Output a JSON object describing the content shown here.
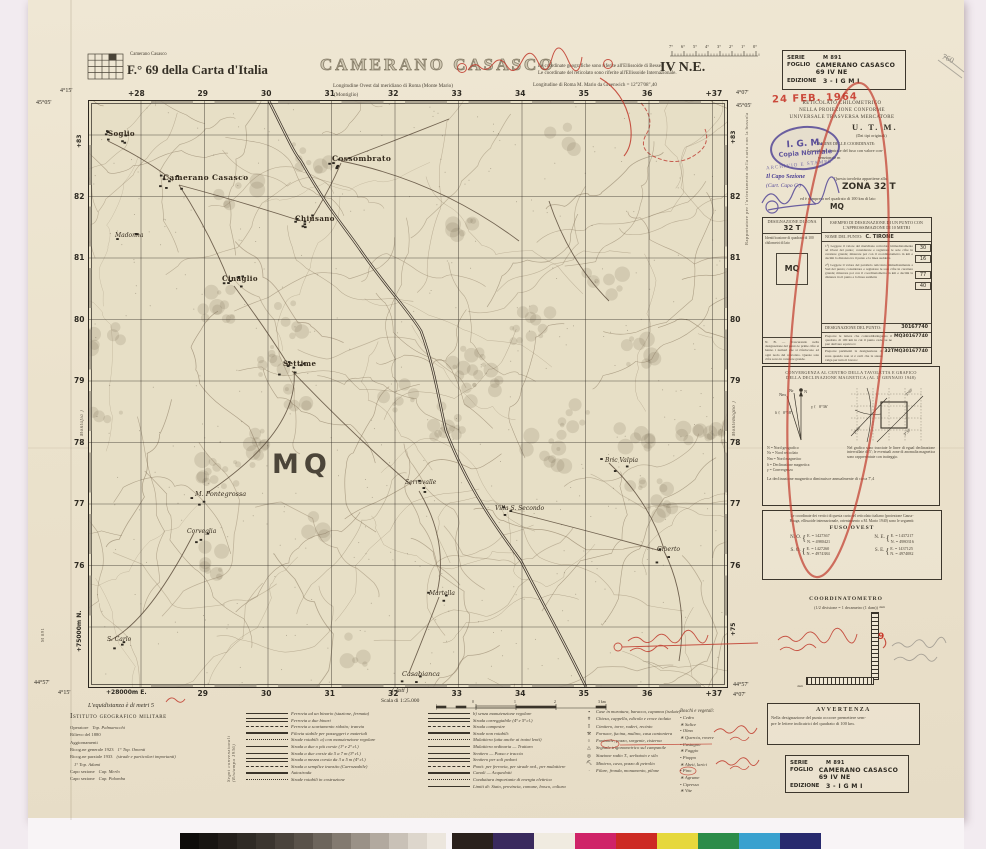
{
  "header": {
    "index_label": "Camerano Casasco",
    "sheet_ref": "F.° 69  della Carta d'Italia",
    "title": "CAMERANO CASASCO",
    "long_west": "Longitudine Ovest dal meridiano di Roma (Monte Mario)",
    "montiglio": "(Montiglio)",
    "coords_note1": "Le coordinate geografiche sono riferite all'Ellissoide di Bessel.",
    "coords_note2": "Le coordinate del reticolato sono riferite all'Ellissoide Internazionale.",
    "long_rome": "Longitudine di Roma M. Mario da Greenwich = 12°27'08\",40",
    "quadrant": "IV N.E.",
    "degree_ticks": [
      "7°",
      "6°",
      "5°",
      "4°",
      "3°",
      "2°",
      "1°",
      "0°"
    ],
    "pencil_note": "760"
  },
  "series_box": {
    "serie_label": "SERIE",
    "serie": "M 891",
    "foglio_label": "FOGLIO",
    "foglio": "CAMERANO CASASCO 69 IV NE",
    "edizione_label": "EDIZIONE",
    "edizione": "3    -  I G M I"
  },
  "stamps": {
    "date": "24 FEB. 1964",
    "igm1": "I. G. M.",
    "igm2": "Copia Normale",
    "igm3": "ARCHIVIO E STAMPE",
    "capo1": "Il Capo Sezione",
    "capo2": "(Cart. Capo C.)"
  },
  "utm": {
    "l1": "RETICOLATO CHILOMETRICO",
    "l2": "NELLA PROIEZIONE CONFORME",
    "l3": "UNIVERSALE TRASVERSA MERCATORE",
    "l4": "U. T. M.",
    "l5": "(Dai tipi originali)",
    "l6": "ORIGINE DELLE COORDINATE:",
    "l7": "il meridiano centrale del fuso con valore con-",
    "l8": "venzionale m",
    "l9": "Questa tavoletta appartiene alla",
    "zona": "ZONA  32 T",
    "l10": "ed è compresa nel quadrato di 100 km di lato",
    "mq": "MQ"
  },
  "desig_table": {
    "c1h": "DESIGNAZIONE DI ZONA",
    "c1zone": "32 T",
    "c1sq": "Identificazione di quadrato di 100 chilometri di lato",
    "c1mq": "MQ",
    "c2h": "ESEMPIO DI DESIGNAZIONE DI UN PUNTO CON L'APPROSSIMAZIONE DI 10 METRI",
    "point_label": "NOME DEL PUNTO:",
    "point": "C. TIRONE",
    "step1": "1°) Leggere il valore del meridiano reticolato immediatamente ad Ovest del punto; considerare e registrare le sole cifre in carattere grande; misurare poi con il coordinatometro in km e decimi la distanza tra il punto e la linea suddetta",
    "n1": "30",
    "n2": "16",
    "step2": "2°) Leggere il valore del parallelo reticolato immediatamente a Sud del punto; considerare e registrare le sole cifre in carattere grande; misurare poi con il coordinatometro in km e decimi la distanza tra il punto e la linea suddetta",
    "n3": "77",
    "n4": "40",
    "desig_label": "DESIGNAZIONE DEL PUNTO:",
    "desig": "30167740",
    "nb": "N. B. — Trascurando nella designazione del punto le prime cifre si hanno i numeri che si riferiscono ad ogni nodo del reticolato. Queste sole cifre sono in carattere grande.",
    "r1": "Preporre le lettere che contraddistinguono il quadrato di 100 km in cui il punto cade, se ne può derivare equivoco:",
    "v1": "MQ30167740",
    "r2": "Preporre parimenti la designazione di zona quando non si è certi che la stessa valga per tutto il lavoro:",
    "v2": "32TMQ30167740"
  },
  "conv_box": {
    "title1": "CONVERGENZA AL CENTRO DELLA TAVOLETTA E GRAFICO",
    "title2": "DELLA DECLINAZIONE MAGNETICA (AL 1° GENNAIO 1948)",
    "val1": "0°36'",
    "val2": "0°58'",
    "diag1": "3°00'",
    "diag2": "2°30'",
    "diag3": "3°30'",
    "legend": [
      "N  =  Nord geografico",
      "Nr =  Nord reticolato",
      "Nm =  Nord magnetico",
      "δ  =  Declinazione magnetica",
      "γ  =  Convergenza"
    ],
    "note": "Nel grafico sono tracciate le linee di egual declinazione intervallate di 5'; le eventuali zone di anomalia magnetica sono rappresentate con tratteggio.",
    "bottom": "La declinazione magnetica diminuisce annualmente di circa 7',4"
  },
  "fuso_box": {
    "intro1": "Le coordinate dei vertici di questa carta nel reticolato italiano (proiezione Gauss-",
    "intro2": "Boaga, ellissoide internazionale, orientamento a M. Mario 1940) sono le seguenti:",
    "title": "FUSO OVEST",
    "no_l": "N. O.",
    "no_e": "E. =  1427367",
    "no_n": "N. =  4980421",
    "ne_l": "N. E.",
    "ne_e": "E. =  1437217",
    "ne_n": "N. =  4980316",
    "so_l": "S. O.",
    "so_e": "E. =  1427260",
    "so_n": "N. =  4974384",
    "se_l": "S. E.",
    "se_e": "E. =  1437125",
    "se_n": "N. =  4974082"
  },
  "coordinatometro": {
    "title": "COORDINATOMETRO",
    "sub": "(1/2 divisione = 1 decametro (1 dam))",
    "dam1": "dam",
    "dam2": "dam",
    "red_mark": "9"
  },
  "avvertenza": {
    "title": "AVVERTENZA",
    "l1": "Nella designazione del punto occorre premettere sem-",
    "l2": "pre le lettere indicatrici del quadrato di 100 km."
  },
  "footer": {
    "equidistanza": "L'equidistanza è di metri 5",
    "igm": "Istituto geografico militare",
    "credits": [
      {
        "a": "Operatore",
        "b": "Top. Palmarocchi"
      },
      {
        "a": "Rilievo del 1880",
        "b": ""
      },
      {
        "a": "Aggiornamenti",
        "b": ""
      },
      {
        "a": "Ricog.ne generale 1923",
        "b": "1° Top. Omenti"
      },
      {
        "a": "Ricog.ne parziale 1933",
        "b": "(strade e particolari importanti)"
      },
      {
        "a": "",
        "b": "1° Top. Adami"
      },
      {
        "a": "Capo sezione",
        "b": "Cap. Merlo"
      },
      {
        "a": "Capo sezione",
        "b": "Cap. Palomba"
      }
    ],
    "rotated": "Segni convenzionali (Ristampa 1936)",
    "scale_label": "Scala di 1:25.000",
    "asti": "( Asti )",
    "edge_left_rot": "( Montafia )",
    "edge_right_rot": "( Montemagno )",
    "sheet_code": "M 891"
  },
  "legend": {
    "colA": [
      "Ferrovia ad un binario (stazione, fermata)",
      "Ferrovia a due binari",
      "Ferrovia a scartamento ridotto; tranvia",
      "Filovia stabile per passeggeri e materiali",
      "Strade rotabili:  a) con manutenzione regolare",
      "Strada a due o più corsie (1ª e 2ª cl.)",
      "Strada a due corsie da 5 a 7 m (3ª cl.)",
      "Strada a mezza corsia da 3 a 5 m (4ª cl.)",
      "Strada a semplice transito (Carrozzabile)",
      "Autostrada",
      "Strade rotabili in costruzione"
    ],
    "colB": [
      "b) senza manutenzione regolare",
      "Strada carreggiabile (4ª e 5ª cl.)",
      "Strada campestre",
      "Strade non rotabili:",
      "Mulattiera (atta anche ai traini lenti)",
      "Mulattiera ordinaria — Tratturo",
      "Sentiero — Passo e traccia",
      "Sentiero per soli pedoni",
      "Ponti: per ferrovia, per strade ord., per mulattiere",
      "Canali — Acquedotti",
      "Conduttura importante di energia elettrica",
      "Limiti di: Stato, provincia, comune, bosco, coltura"
    ],
    "colC": [
      "Case in muratura, baracca, capanna (isolate)",
      "Chiesa, cappella, edicola e croce isolata",
      "Cimitero, torre, ruderi, recinto",
      "Fornace, fucina, mulino, casa cantoniera",
      "Fontanile, pozzo, sorgente, cisterna",
      "Segnale trigonometrico sul campanile",
      "Stazione radio T., serbatoio e silo",
      "Miniera, cava, pozzo di petrolio",
      "Filare, fronda, monumento, pilone"
    ],
    "trees_header": "Boschi e vegetali:",
    "trees": [
      "Cedro",
      "Salice",
      "Olmo",
      "Quercia, rovere",
      "Castagno",
      "Faggio",
      "Pioppo",
      "Abeti, larici",
      "Pino",
      "Agrume",
      "Cipresso",
      "Vite"
    ]
  },
  "map": {
    "grid_top": [
      "+28",
      "29",
      "30",
      "31",
      "32",
      "33",
      "34",
      "35",
      "36",
      "+37"
    ],
    "grid_bottom": [
      "+28000m E.",
      "29",
      "30",
      "31",
      "32",
      "33",
      "34",
      "35",
      "36",
      "+37"
    ],
    "grid_left": [
      "+83",
      "82",
      "81",
      "80",
      "79",
      "78",
      "77",
      "76",
      "+75000m N."
    ],
    "grid_right": [
      "+83",
      "82",
      "81",
      "80",
      "79",
      "78",
      "77",
      "76",
      "+75"
    ],
    "corner_tl_lon": "4°15'",
    "corner_tl_lat": "45°05'",
    "corner_tr_lon": "4°07'",
    "corner_tr_lat": "45°05'",
    "corner_bl_lat": "44°57'",
    "corner_bl_lon": "4°15'",
    "corner_br_lat": "44°57'",
    "corner_br_lon": "4°07'",
    "mq_label": "MQ",
    "towns": [
      {
        "n": "Soglio",
        "x": 19,
        "y": 28,
        "s": 7,
        "b": 1
      },
      {
        "n": "Cossombrato",
        "x": 243,
        "y": 53,
        "s": 7.5,
        "b": 1
      },
      {
        "n": "Camerano Casasco",
        "x": 74,
        "y": 72,
        "s": 7.5,
        "b": 1
      },
      {
        "n": "Chiusano",
        "x": 206,
        "y": 113,
        "s": 7,
        "b": 1
      },
      {
        "n": "Madonna",
        "x": 26,
        "y": 131,
        "s": 6,
        "b": 0
      },
      {
        "n": "Cinaglio",
        "x": 133,
        "y": 173,
        "s": 7,
        "b": 1
      },
      {
        "n": "Settime",
        "x": 194,
        "y": 258,
        "s": 7,
        "b": 1
      },
      {
        "n": "Bric Valpia",
        "x": 516,
        "y": 356,
        "s": 6,
        "b": 0
      },
      {
        "n": "Serravalle",
        "x": 316,
        "y": 378,
        "s": 6,
        "b": 0
      },
      {
        "n": "M. Pontegrossa",
        "x": 106,
        "y": 389,
        "s": 6.5,
        "b": 0
      },
      {
        "n": "Villa S. Secondo",
        "x": 406,
        "y": 404,
        "s": 6,
        "b": 0
      },
      {
        "n": "Corveglia",
        "x": 98,
        "y": 427,
        "s": 6,
        "b": 0
      },
      {
        "n": "Giberto",
        "x": 568,
        "y": 445,
        "s": 6,
        "b": 0
      },
      {
        "n": "Martella",
        "x": 340,
        "y": 489,
        "s": 6,
        "b": 0
      },
      {
        "n": "S. Carlo",
        "x": 18,
        "y": 535,
        "s": 6,
        "b": 0
      },
      {
        "n": "Casabianca",
        "x": 313,
        "y": 569,
        "s": 6.5,
        "b": 0
      }
    ]
  },
  "colorbar": {
    "grays": [
      "#0e0c0a",
      "#181512",
      "#241f1b",
      "#2f2a25",
      "#3b352f",
      "#4a433c",
      "#5a524a",
      "#6d655c",
      "#837a70",
      "#9a9187",
      "#b2a99f",
      "#c9c1b7",
      "#ddd6cc",
      "#ece6dd"
    ],
    "colors": [
      "#2a211c",
      "#3a2a5e",
      "#f0ebe0",
      "#cf2368",
      "#cd2a24",
      "#e6d83c",
      "#2c8c49",
      "#39a1cf",
      "#282a6e"
    ]
  }
}
